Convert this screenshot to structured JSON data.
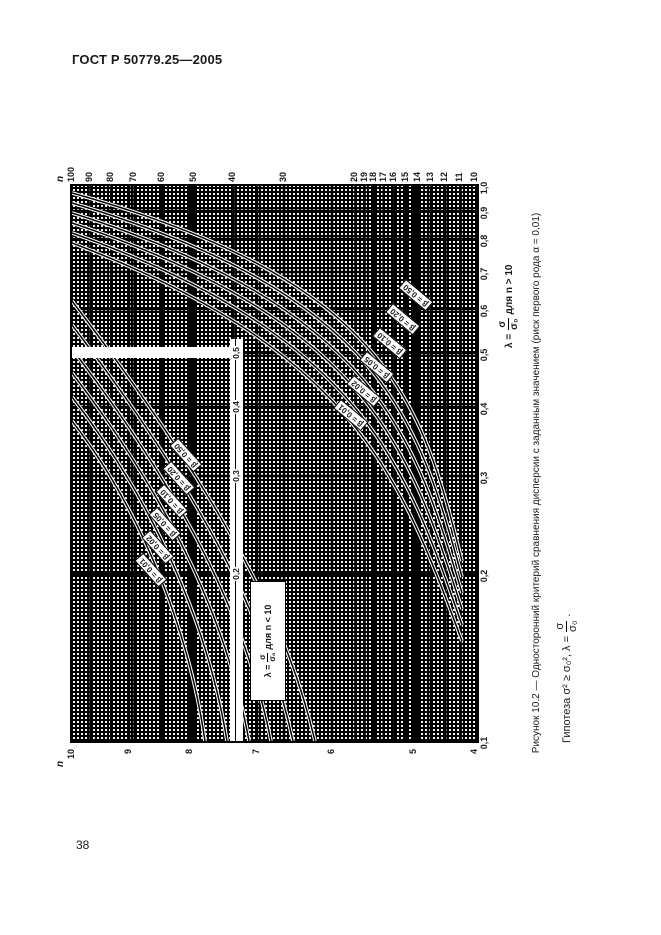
{
  "page": {
    "header": "ГОСТ Р 50779.25—2005",
    "page_number": "38",
    "colors": {
      "ink": "#000000",
      "paper": "#ffffff"
    }
  },
  "figure": {
    "caption": "Рисунок 10.2 — Односторонний критерий сравнения дисперсии с заданным значением (риск первого рода α = 0,01)",
    "hypothesis": {
      "before": "Гипотеза  σ² ≥ σ₀²,  λ =",
      "frac_num": "σ",
      "frac_den": "σ₀",
      "after": "."
    },
    "axis_bottom": {
      "lambda_eq": "λ =",
      "frac_num": "σ",
      "frac_den": "σ₀",
      "condition": "для n > 10",
      "ticks": [
        "0,1",
        "0,2",
        "0,3",
        "0,4",
        "0,5",
        "0,6",
        "0,7",
        "0,8",
        "0,9",
        "1,0"
      ]
    },
    "axis_internal": {
      "lambda_eq": "λ =",
      "frac_num": "σ",
      "frac_den": "σ₀",
      "condition": "для n < 10",
      "ticks": [
        "0,2",
        "0,3",
        "0,4",
        "0,5"
      ]
    },
    "axis_right": {
      "title": "n",
      "ticks": [
        "100",
        "90",
        "80",
        "70",
        "60",
        "50",
        "40",
        "30",
        "20",
        "19",
        "18",
        "17",
        "16",
        "15",
        "14",
        "13",
        "12",
        "11",
        "10"
      ]
    },
    "axis_left": {
      "title": "n",
      "ticks": [
        "10",
        "9",
        "8",
        "7",
        "6",
        "5",
        "4"
      ]
    },
    "beta_labels_small_n": [
      "β = 0,01",
      "β = 0,02",
      "β = 0,05",
      "β = 0,10",
      "β = 0,20",
      "β = 0,50"
    ],
    "beta_labels_large_n": [
      "β = 0,01",
      "β = 0,02",
      "β = 0,05",
      "β = 0,10",
      "β = 0,20",
      "β = 0,50"
    ]
  },
  "chart_data": {
    "type": "line",
    "title": "Рисунок 10.2 — Односторонний критерий сравнения дисперсии с заданным значением (риск первого рода α = 0,01)",
    "xlabel": "λ = σ/σ₀",
    "ylabel": "n",
    "x_scale": "log",
    "y_scale": "log",
    "x_range": [
      0.1,
      1.0
    ],
    "right_axis_n_range": [
      10,
      100
    ],
    "left_axis_n_range": [
      4,
      10
    ],
    "grid": "dense log-log",
    "legend_position": "labels on curves",
    "series": [
      {
        "name": "n>10, β=0,01",
        "points": [
          [
            0.15,
            11
          ],
          [
            0.37,
            20
          ],
          [
            0.79,
            100
          ]
        ]
      },
      {
        "name": "n>10, β=0,02",
        "points": [
          [
            0.16,
            11
          ],
          [
            0.4,
            19
          ],
          [
            0.83,
            100
          ]
        ]
      },
      {
        "name": "n>10, β=0,05",
        "points": [
          [
            0.17,
            11
          ],
          [
            0.44,
            18
          ],
          [
            0.87,
            100
          ]
        ]
      },
      {
        "name": "n>10, β=0,10",
        "points": [
          [
            0.19,
            11
          ],
          [
            0.47,
            17
          ],
          [
            0.9,
            100
          ]
        ]
      },
      {
        "name": "n>10, β=0,20",
        "points": [
          [
            0.2,
            11
          ],
          [
            0.49,
            16
          ],
          [
            0.93,
            100
          ]
        ]
      },
      {
        "name": "n>10, β=0,50",
        "points": [
          [
            0.21,
            11
          ],
          [
            0.51,
            15
          ],
          [
            0.96,
            100
          ]
        ]
      },
      {
        "name": "n<10, β=0,01",
        "points": [
          [
            0.1,
            7.6
          ],
          [
            0.25,
            8.8
          ],
          [
            0.38,
            10
          ]
        ]
      },
      {
        "name": "n<10, β=0,02",
        "points": [
          [
            0.1,
            7.3
          ],
          [
            0.27,
            8.6
          ],
          [
            0.41,
            10
          ]
        ]
      },
      {
        "name": "n<10, β=0,05",
        "points": [
          [
            0.1,
            6.9
          ],
          [
            0.29,
            8.3
          ],
          [
            0.45,
            10
          ]
        ]
      },
      {
        "name": "n<10, β=0,10",
        "points": [
          [
            0.1,
            6.6
          ],
          [
            0.31,
            8.1
          ],
          [
            0.49,
            10
          ]
        ]
      },
      {
        "name": "n<10, β=0,20",
        "points": [
          [
            0.1,
            6.3
          ],
          [
            0.33,
            7.9
          ],
          [
            0.54,
            10
          ]
        ]
      },
      {
        "name": "n<10, β=0,50",
        "points": [
          [
            0.1,
            6.1
          ],
          [
            0.35,
            7.7
          ],
          [
            0.6,
            10
          ]
        ]
      }
    ]
  }
}
